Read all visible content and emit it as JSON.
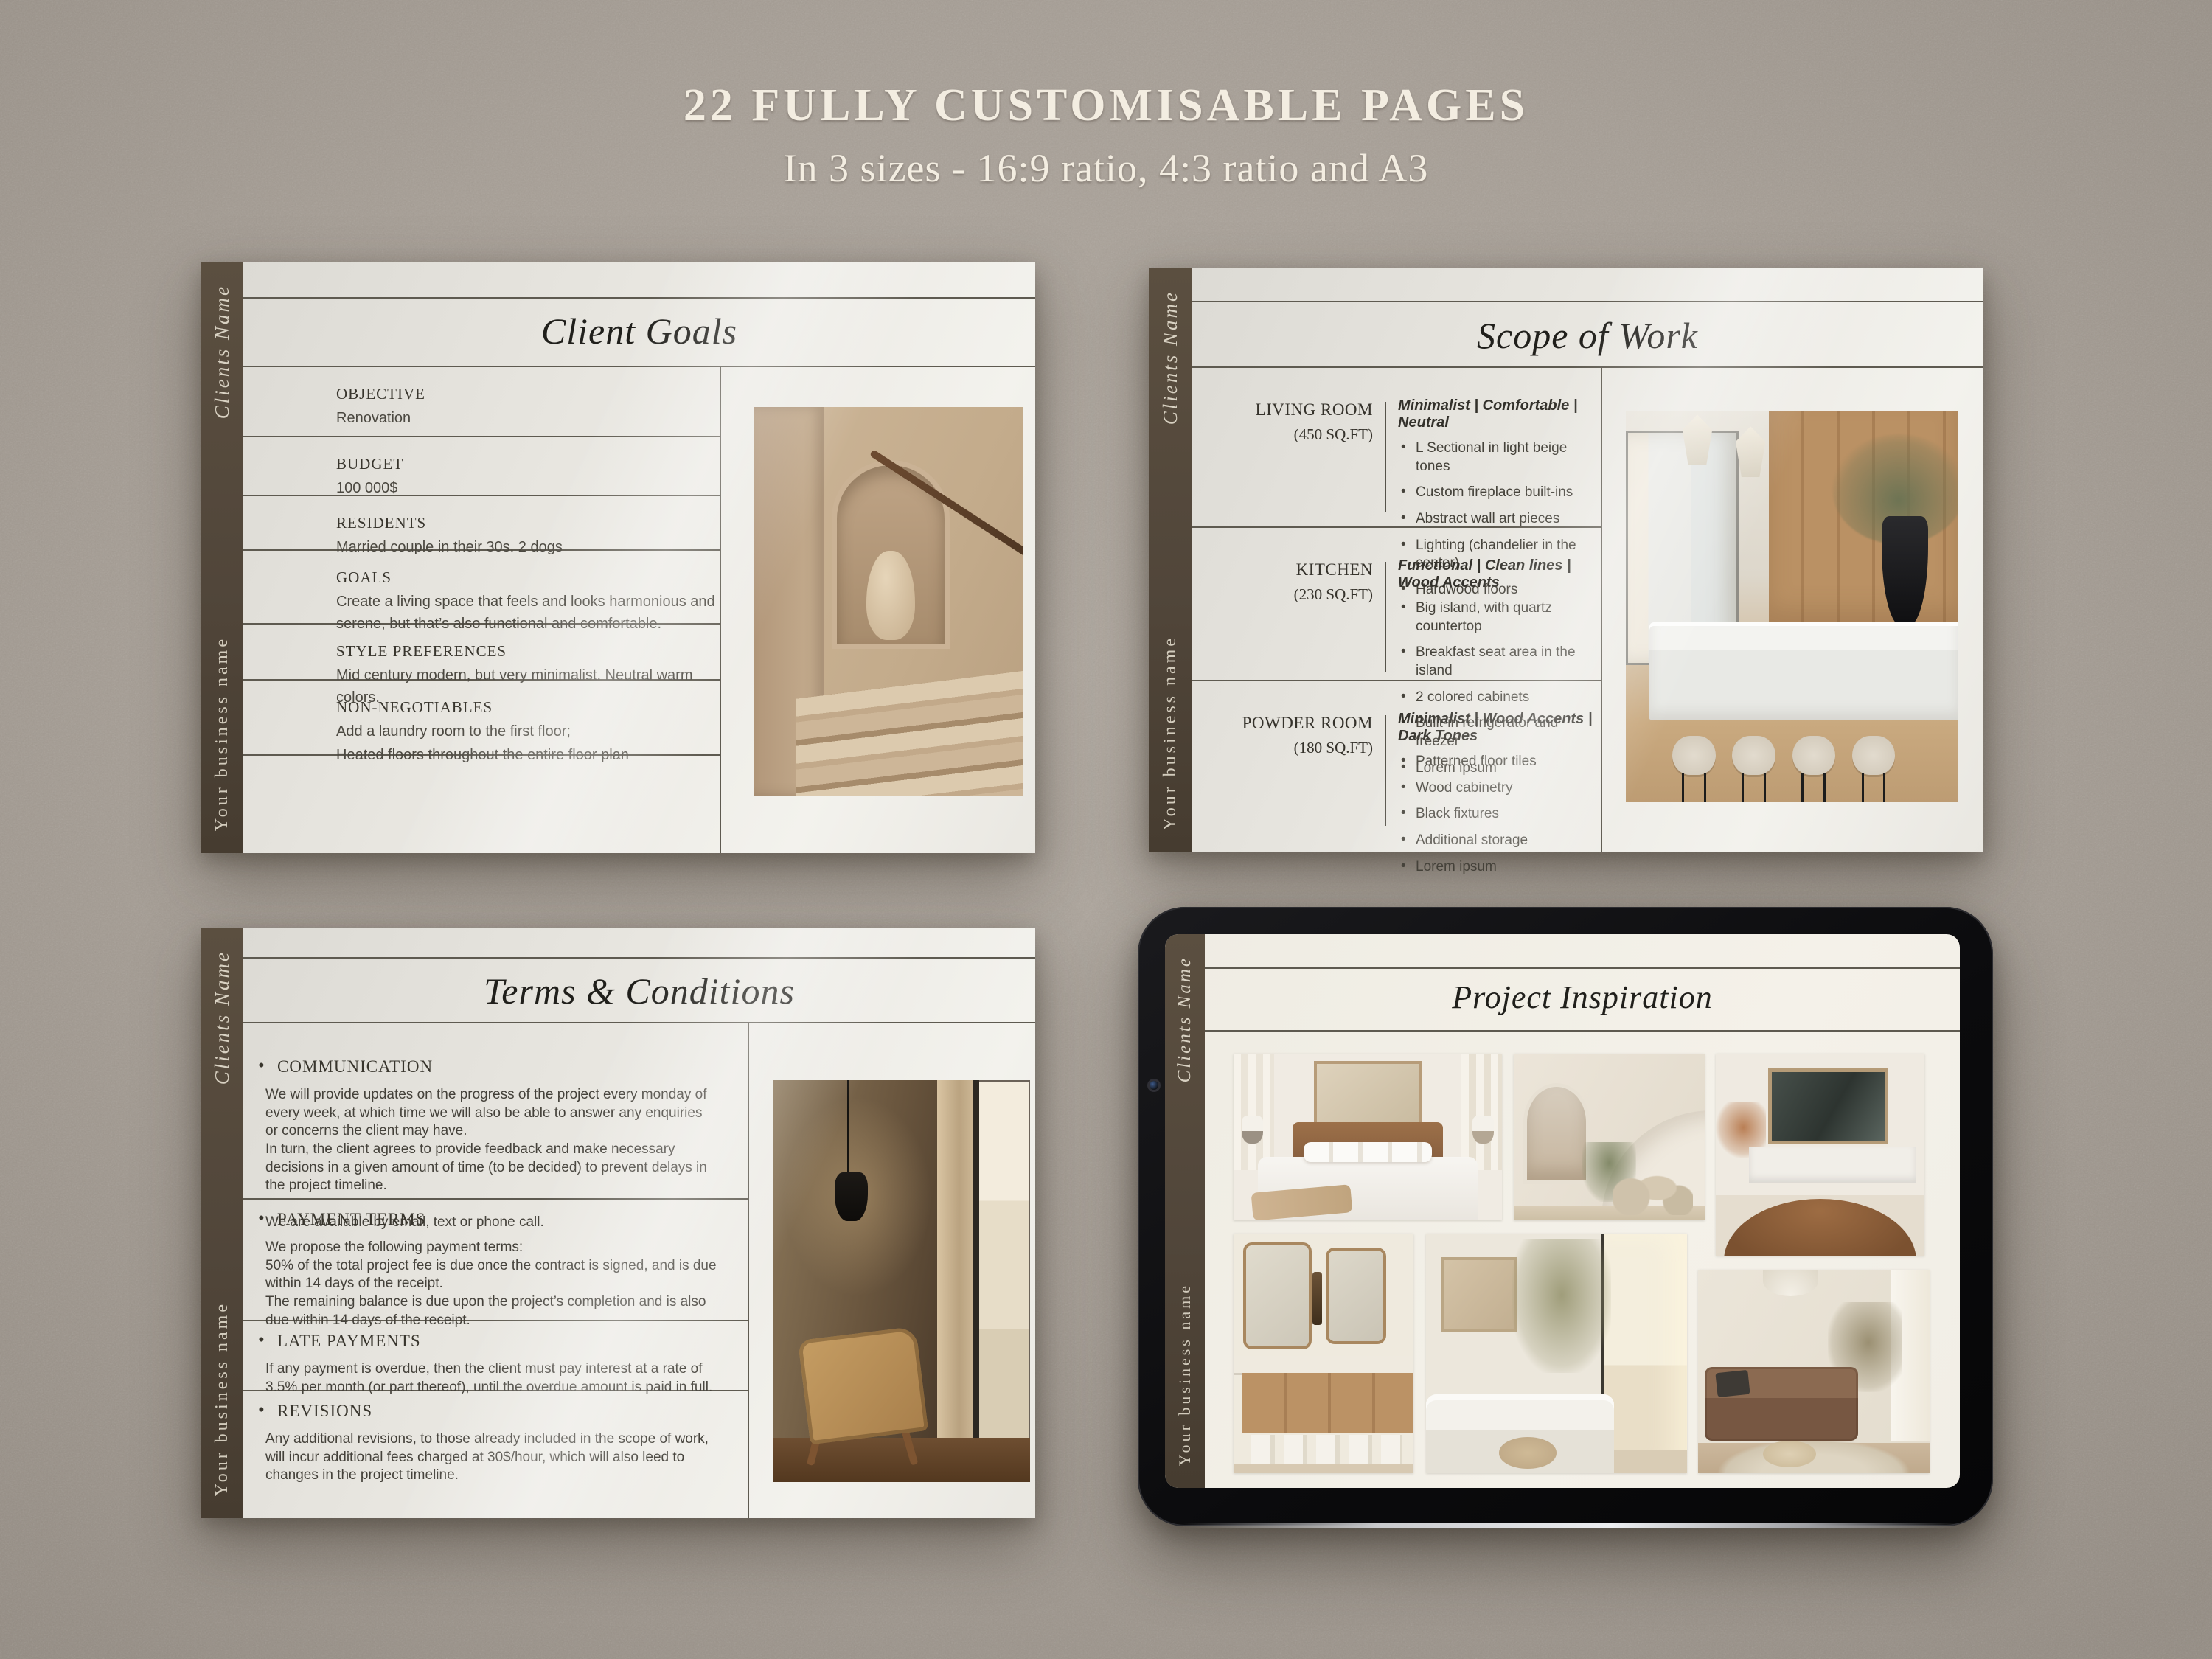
{
  "header": {
    "title": "22 FULLY CUSTOMISABLE PAGES",
    "subtitle": "In 3 sizes - 16:9 ratio, 4:3 ratio and A3"
  },
  "branding": {
    "client_label": "Clients Name",
    "business_label": "Your business name"
  },
  "colors": {
    "background": "#a69e95",
    "page": "#ece9e3",
    "sidebar": "#51463a",
    "line": "#5e5a50",
    "title_text": "#201f1b",
    "body_text": "#46433b",
    "tablet_bezel": "#0b0b0d",
    "tablet_screen": "#f2efe8"
  },
  "pages": {
    "client_goals": {
      "title": "Client Goals",
      "photo": "stairway-with-vase-niche",
      "sections": [
        {
          "label": "OBJECTIVE",
          "text": "Renovation"
        },
        {
          "label": "BUDGET",
          "text": "100 000$"
        },
        {
          "label": "RESIDENTS",
          "text": "Married couple in their 30s. 2 dogs"
        },
        {
          "label": "GOALS",
          "text": "Create a living space that feels and looks harmonious and serene, but that’s also functional and comfortable."
        },
        {
          "label": "STYLE PREFERENCES",
          "text": "Mid century modern, but very minimalist. Neutral warm colors."
        },
        {
          "label": "NON-NEGOTIABLES",
          "text": "Add a laundry room to the first floor;",
          "text2": "Heated floors throughout the entire floor plan"
        }
      ]
    },
    "scope_of_work": {
      "title": "Scope of Work",
      "photo": "kitchen-island-with-stools",
      "rooms": [
        {
          "name": "LIVING ROOM",
          "size": "(450 SQ.FT)",
          "tags": "Minimalist | Comfortable | Neutral",
          "bullets": [
            "L Sectional in light beige tones",
            "Custom fireplace built-ins",
            "Abstract wall art pieces",
            "Lighting (chandelier in the center)",
            "Hardwood floors"
          ]
        },
        {
          "name": "KITCHEN",
          "size": "(230 SQ.FT)",
          "tags": "Functional | Clean lines | Wood Accents",
          "bullets": [
            "Big island, with quartz countertop",
            "Breakfast seat area in the island",
            "2 colored cabinets",
            "Built-in refrigerator and freezer",
            "Lorem ipsum"
          ]
        },
        {
          "name": "POWDER ROOM",
          "size": "(180 SQ.FT)",
          "tags": "Minimalist | Wood Accents | Dark Tones",
          "bullets": [
            "Patterned floor tiles",
            "Wood cabinetry",
            "Black fixtures",
            "Additional storage",
            "Lorem ipsum"
          ]
        }
      ]
    },
    "terms": {
      "title": "Terms & Conditions",
      "photo": "lounge-chair-by-window",
      "sections": [
        {
          "heading": "COMMUNICATION",
          "paragraphs": [
            "We will provide updates on the progress of the project every monday of every week, at which time we will also be able to answer any enquiries or concerns the client may have.",
            "In turn, the client agrees to provide feedback and make necessary decisions in a given amount of time (to be decided) to prevent delays in the project timeline.",
            "We are available by email, text or phone call."
          ]
        },
        {
          "heading": "PAYMENT TERMS",
          "paragraphs": [
            "We propose the following payment terms:",
            "50% of the total project fee is due once the contract is signed, and is due within 14 days of the receipt.",
            "The remaining balance is due upon the project’s completion and is also due within 14 days of the receipt."
          ]
        },
        {
          "heading": "LATE PAYMENTS",
          "paragraphs": [
            "If any payment is overdue, then the client must pay interest at a rate of 3.5% per month (or part thereof), until the overdue amount is paid in full."
          ]
        },
        {
          "heading": "REVISIONS",
          "paragraphs": [
            "Any additional revisions, to those already included in the scope of work, will incur additional fees charged at 30$/hour, which will also leed to changes in the project timeline."
          ]
        }
      ]
    },
    "inspiration": {
      "title": "Project Inspiration",
      "photos": [
        "bedroom",
        "staircase-hall",
        "dining-room",
        "bathroom-vanity",
        "living-room-sectional",
        "brown-sofa-lounge"
      ]
    }
  }
}
